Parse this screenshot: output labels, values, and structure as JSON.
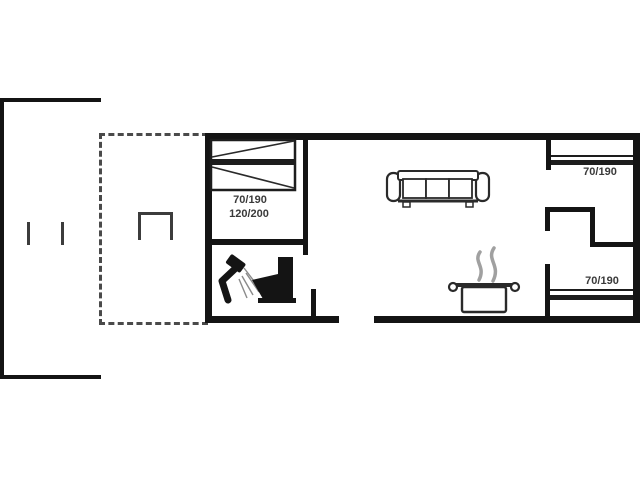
{
  "plan": {
    "type": "house-floor-plan",
    "labels": {
      "main_bed_size_1": "70/190",
      "main_bed_size_2": "120/200",
      "top_right_bed_size": "70/190",
      "bottom_right_bed_size": "70/190"
    },
    "icons": [
      "bunk-bed-icon",
      "sofa-icon",
      "shower-icon",
      "toilet-icon",
      "cooking-pot-icon",
      "steam-icon",
      "grill-icon",
      "terrace-outline",
      "dashed-terrace-outline"
    ],
    "colors": {
      "background": "#ffffff",
      "wall": "#141414",
      "dashed_line": "#4a4a4a",
      "text": "#3a3a3a",
      "steam": "#a0a0a0"
    }
  }
}
